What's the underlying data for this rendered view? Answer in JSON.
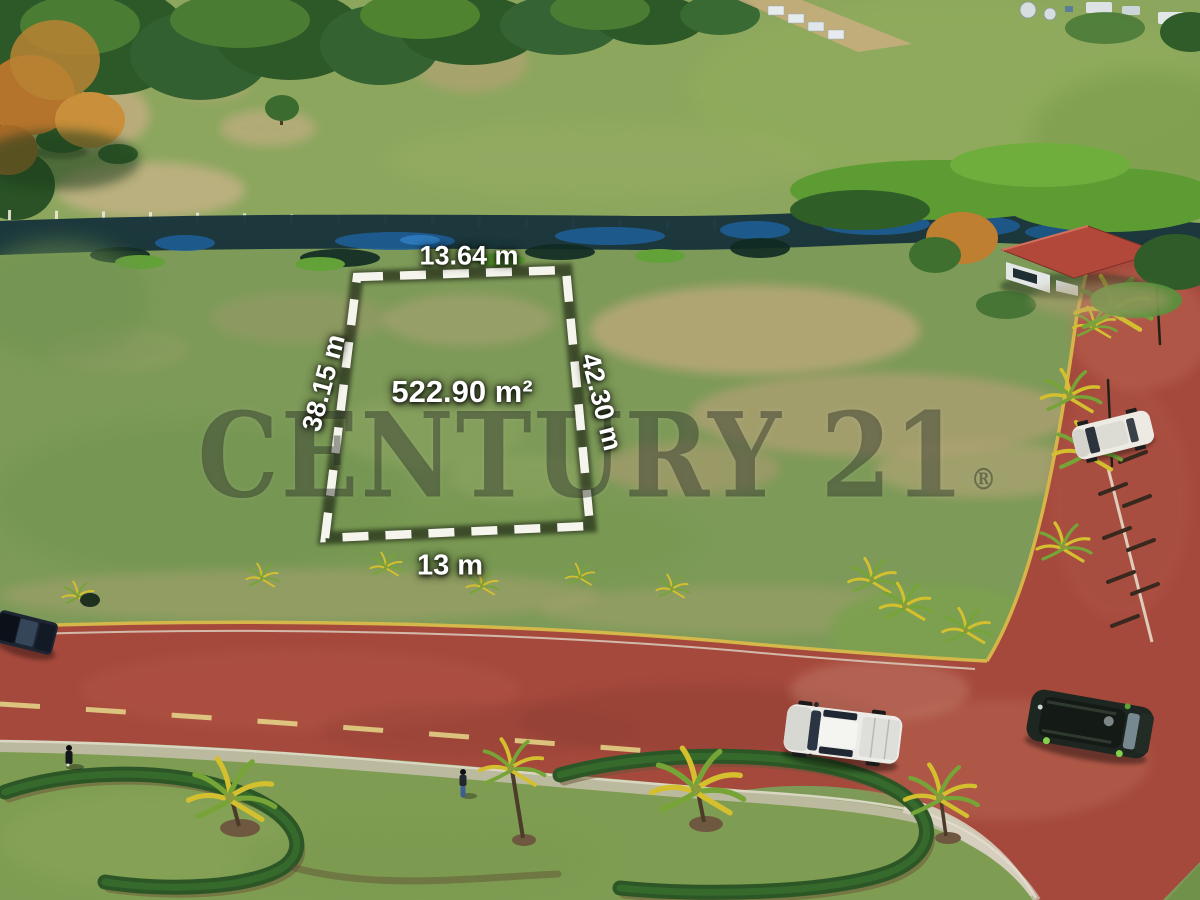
{
  "plot_overlay": {
    "top_dimension": "13.64 m",
    "left_dimension": "38.15 m",
    "right_dimension": "42.30 m",
    "bottom_dimension": "13 m",
    "area": "522.90 m²"
  },
  "watermark": {
    "brand": "CENTURY 21",
    "registered_mark": "®"
  },
  "colors": {
    "boundary_dash": "#f5f4ed",
    "label_text": "#ffffff",
    "road_brick": "#a5493c",
    "field_green": "#7d9a58",
    "creek_water": "#1e5f9a",
    "watermark_tint": "#1c2218"
  }
}
